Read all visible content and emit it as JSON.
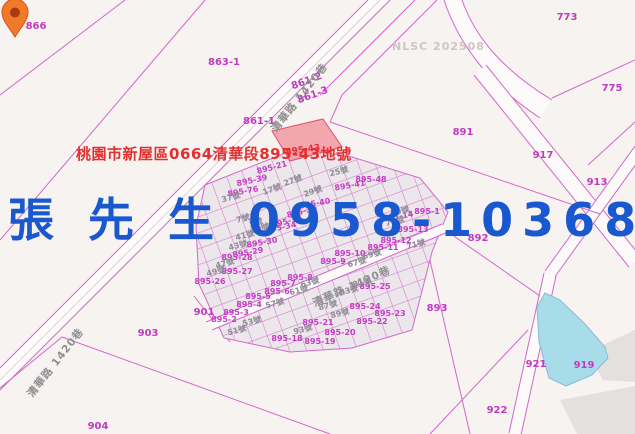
{
  "map": {
    "provider_watermark": "NLSC 202508",
    "annotation": {
      "address": "桃園市新屋區0664清華段895-43地號",
      "color": "#e42f2f"
    },
    "contact_overlay": {
      "text": "張 先 生 0958-103680",
      "color": "#1a58d0"
    },
    "selected_parcel": {
      "id": "895-43",
      "highlight_fill": "#f2929e",
      "label_color": "#e42f2f"
    },
    "marker": {
      "name": "location-pin",
      "color": "#ee7a2a"
    },
    "pond": {
      "parcel": "919",
      "color": "#a9dce9"
    },
    "colors": {
      "background": "#f6f3f0",
      "boundary": "#d367cc",
      "cluster_fill": "#ebe7eb",
      "road_fill": "#fcfbfa",
      "building_fill": "#e3e0de"
    },
    "road_name": "清華路 1420巷",
    "labels": [
      {
        "t": "866",
        "k": "big",
        "x": 36,
        "y": 27,
        "r": 0
      },
      {
        "t": "863-1",
        "k": "big",
        "x": 224,
        "y": 63,
        "r": 0
      },
      {
        "t": "773",
        "k": "big",
        "x": 567,
        "y": 18,
        "r": 0
      },
      {
        "t": "775",
        "k": "big",
        "x": 612,
        "y": 89,
        "r": 0
      },
      {
        "t": "891",
        "k": "big",
        "x": 463,
        "y": 133,
        "r": 0
      },
      {
        "t": "917",
        "k": "big",
        "x": 543,
        "y": 156,
        "r": 0
      },
      {
        "t": "913",
        "k": "big",
        "x": 597,
        "y": 183,
        "r": 0
      },
      {
        "t": "892",
        "k": "big",
        "x": 478,
        "y": 239,
        "r": 0
      },
      {
        "t": "893",
        "k": "big",
        "x": 437,
        "y": 309,
        "r": 0
      },
      {
        "t": "903",
        "k": "big",
        "x": 148,
        "y": 334,
        "r": 0
      },
      {
        "t": "904",
        "k": "big",
        "x": 98,
        "y": 427,
        "r": 0
      },
      {
        "t": "901",
        "k": "big",
        "x": 204,
        "y": 313,
        "r": 0
      },
      {
        "t": "922",
        "k": "big",
        "x": 497,
        "y": 411,
        "r": 0
      },
      {
        "t": "921",
        "k": "big",
        "x": 536,
        "y": 365,
        "r": 0
      },
      {
        "t": "919",
        "k": "big",
        "x": 584,
        "y": 366,
        "r": 0
      },
      {
        "t": "861-2",
        "k": "big",
        "x": 307,
        "y": 82,
        "r": -20
      },
      {
        "t": "861-3",
        "k": "big",
        "x": 313,
        "y": 96,
        "r": -20
      },
      {
        "t": "861-1",
        "k": "big",
        "x": 259,
        "y": 122,
        "r": 0
      },
      {
        "t": "895-43",
        "k": "sel",
        "x": 303,
        "y": 151,
        "r": -8
      },
      {
        "t": "895-21",
        "k": "small",
        "x": 272,
        "y": 168,
        "r": -15
      },
      {
        "t": "895-39",
        "k": "small",
        "x": 252,
        "y": 181,
        "r": -12
      },
      {
        "t": "895-76",
        "k": "small",
        "x": 243,
        "y": 192,
        "r": -10
      },
      {
        "t": "895-41",
        "k": "small",
        "x": 350,
        "y": 186,
        "r": -10
      },
      {
        "t": "895-48",
        "k": "small",
        "x": 371,
        "y": 180,
        "r": 0
      },
      {
        "t": "895-40",
        "k": "small",
        "x": 315,
        "y": 204,
        "r": -10
      },
      {
        "t": "895-33",
        "k": "small",
        "x": 287,
        "y": 222,
        "r": -15
      },
      {
        "t": "895-36",
        "k": "small",
        "x": 302,
        "y": 212,
        "r": -15
      },
      {
        "t": "895-14",
        "k": "small",
        "x": 398,
        "y": 217,
        "r": -10
      },
      {
        "t": "895-1",
        "k": "small",
        "x": 427,
        "y": 212,
        "r": 0
      },
      {
        "t": "895-34",
        "k": "small",
        "x": 281,
        "y": 228,
        "r": -12
      },
      {
        "t": "895-30",
        "k": "small",
        "x": 262,
        "y": 243,
        "r": -10
      },
      {
        "t": "895-29",
        "k": "small",
        "x": 248,
        "y": 253,
        "r": -10
      },
      {
        "t": "895-28",
        "k": "small",
        "x": 237,
        "y": 258,
        "r": 0
      },
      {
        "t": "895-27",
        "k": "small",
        "x": 237,
        "y": 272,
        "r": 0
      },
      {
        "t": "895-26",
        "k": "small",
        "x": 210,
        "y": 282,
        "r": 0
      },
      {
        "t": "895-13",
        "k": "small",
        "x": 413,
        "y": 230,
        "r": 0
      },
      {
        "t": "895-12",
        "k": "small",
        "x": 396,
        "y": 241,
        "r": 0
      },
      {
        "t": "895-11",
        "k": "small",
        "x": 383,
        "y": 248,
        "r": 0
      },
      {
        "t": "895-10",
        "k": "small",
        "x": 350,
        "y": 254,
        "r": 0
      },
      {
        "t": "895-9",
        "k": "small",
        "x": 333,
        "y": 262,
        "r": 0
      },
      {
        "t": "895-8",
        "k": "small",
        "x": 300,
        "y": 278,
        "r": 0
      },
      {
        "t": "895-7",
        "k": "small",
        "x": 283,
        "y": 284,
        "r": 0
      },
      {
        "t": "895-6",
        "k": "small",
        "x": 277,
        "y": 292,
        "r": 0
      },
      {
        "t": "895-5",
        "k": "small",
        "x": 258,
        "y": 297,
        "r": 0
      },
      {
        "t": "895-4",
        "k": "small",
        "x": 249,
        "y": 305,
        "r": 0
      },
      {
        "t": "895-3",
        "k": "small",
        "x": 236,
        "y": 313,
        "r": 0
      },
      {
        "t": "895-2",
        "k": "small",
        "x": 224,
        "y": 320,
        "r": 0
      },
      {
        "t": "895-25",
        "k": "small",
        "x": 375,
        "y": 287,
        "r": 0
      },
      {
        "t": "895-24",
        "k": "small",
        "x": 365,
        "y": 307,
        "r": 0
      },
      {
        "t": "895-23",
        "k": "small",
        "x": 390,
        "y": 314,
        "r": 0
      },
      {
        "t": "895-22",
        "k": "small",
        "x": 372,
        "y": 322,
        "r": 0
      },
      {
        "t": "895-21",
        "k": "small",
        "x": 318,
        "y": 323,
        "r": 0
      },
      {
        "t": "895-20",
        "k": "small",
        "x": 340,
        "y": 333,
        "r": 0
      },
      {
        "t": "895-19",
        "k": "small",
        "x": 320,
        "y": 342,
        "r": 0
      },
      {
        "t": "895-18",
        "k": "small",
        "x": 287,
        "y": 339,
        "r": 0
      },
      {
        "t": "25號",
        "k": "house",
        "x": 339,
        "y": 172,
        "r": -15
      },
      {
        "t": "17號",
        "k": "house",
        "x": 272,
        "y": 190,
        "r": -20
      },
      {
        "t": "27號",
        "k": "house",
        "x": 293,
        "y": 181,
        "r": -20
      },
      {
        "t": "29號",
        "k": "house",
        "x": 313,
        "y": 192,
        "r": -20
      },
      {
        "t": "37號",
        "k": "house",
        "x": 231,
        "y": 198,
        "r": -15
      },
      {
        "t": "39號",
        "k": "house",
        "x": 260,
        "y": 229,
        "r": -15
      },
      {
        "t": "41號",
        "k": "house",
        "x": 245,
        "y": 236,
        "r": -15
      },
      {
        "t": "43號",
        "k": "house",
        "x": 238,
        "y": 246,
        "r": -15
      },
      {
        "t": "47號",
        "k": "house",
        "x": 225,
        "y": 264,
        "r": -15
      },
      {
        "t": "49號",
        "k": "house",
        "x": 216,
        "y": 272,
        "r": -15
      },
      {
        "t": "7號",
        "k": "house",
        "x": 243,
        "y": 219,
        "r": -15
      },
      {
        "t": "5號",
        "k": "house",
        "x": 256,
        "y": 223,
        "r": -15
      },
      {
        "t": "63號",
        "k": "house",
        "x": 310,
        "y": 283,
        "r": -15
      },
      {
        "t": "61號",
        "k": "house",
        "x": 299,
        "y": 291,
        "r": -15
      },
      {
        "t": "57號",
        "k": "house",
        "x": 275,
        "y": 304,
        "r": -15
      },
      {
        "t": "53號",
        "k": "house",
        "x": 252,
        "y": 322,
        "r": -15
      },
      {
        "t": "51號",
        "k": "house",
        "x": 237,
        "y": 331,
        "r": -15
      },
      {
        "t": "67號",
        "k": "house",
        "x": 357,
        "y": 263,
        "r": -15
      },
      {
        "t": "69號",
        "k": "house",
        "x": 372,
        "y": 255,
        "r": -15
      },
      {
        "t": "71號",
        "k": "house",
        "x": 416,
        "y": 245,
        "r": -15
      },
      {
        "t": "75號",
        "k": "house",
        "x": 395,
        "y": 222,
        "r": -15
      },
      {
        "t": "79號",
        "k": "house",
        "x": 400,
        "y": 212,
        "r": -15
      },
      {
        "t": "81號",
        "k": "house",
        "x": 362,
        "y": 283,
        "r": -15
      },
      {
        "t": "83號",
        "k": "house",
        "x": 349,
        "y": 291,
        "r": -15
      },
      {
        "t": "87號",
        "k": "house",
        "x": 328,
        "y": 306,
        "r": -15
      },
      {
        "t": "89號",
        "k": "house",
        "x": 340,
        "y": 314,
        "r": -15
      },
      {
        "t": "93號",
        "k": "house",
        "x": 303,
        "y": 330,
        "r": -15
      },
      {
        "t": "清華路 1420巷",
        "k": "road",
        "x": 300,
        "y": 98,
        "r": -52
      },
      {
        "t": "清華路 1420巷",
        "k": "road",
        "x": 56,
        "y": 363,
        "r": -52
      },
      {
        "t": "清華路 1420巷",
        "k": "road",
        "x": 352,
        "y": 287,
        "r": -24
      }
    ]
  }
}
